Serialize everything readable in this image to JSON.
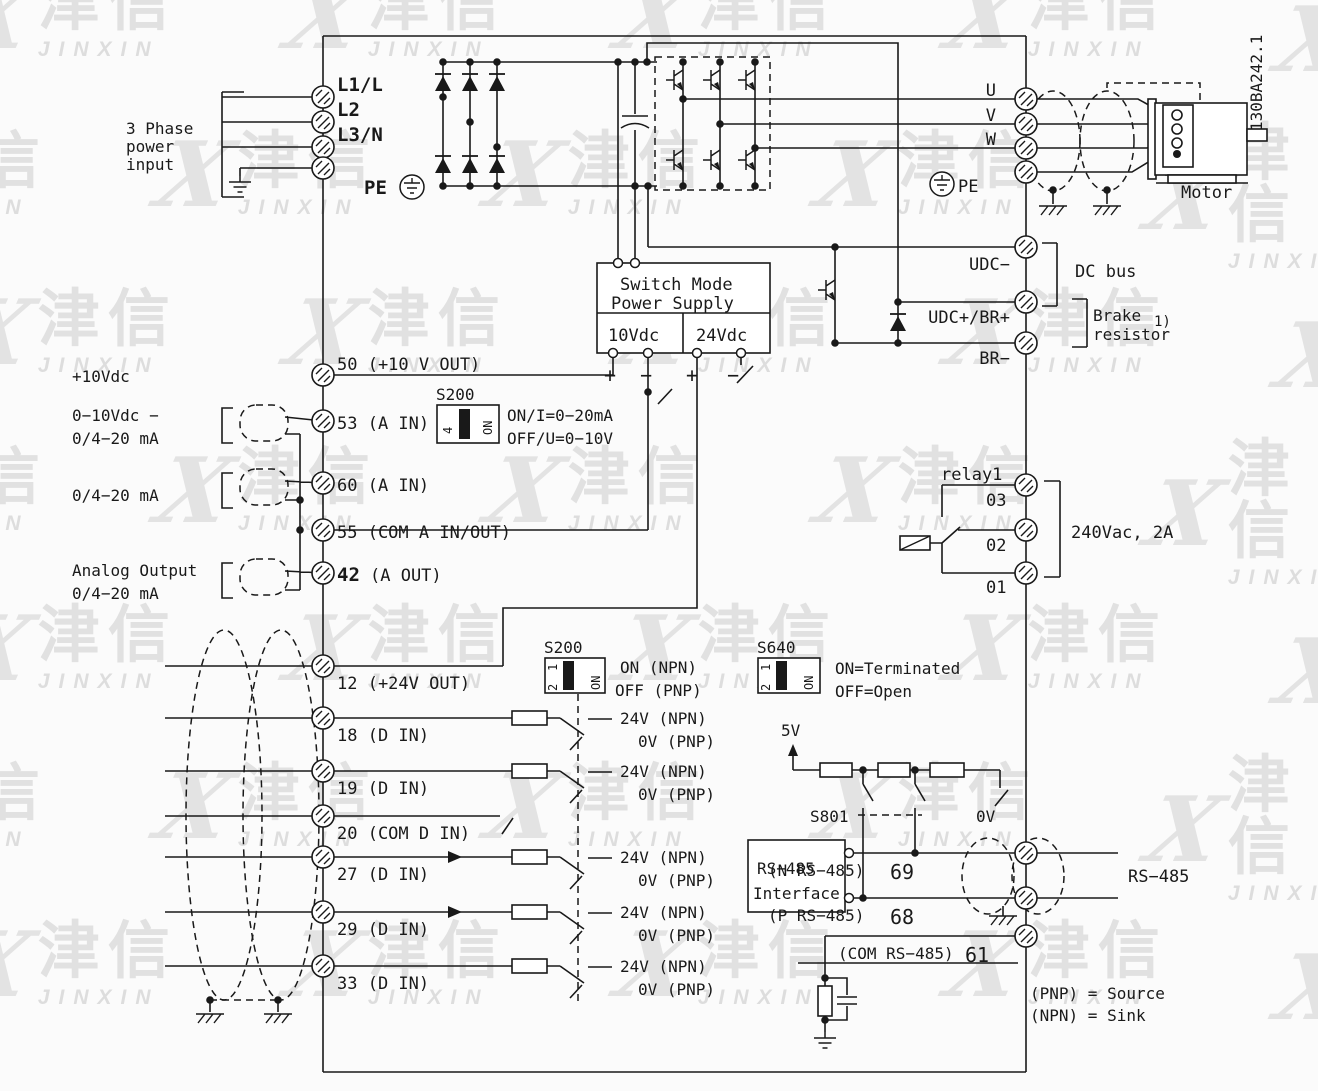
{
  "doc_number": "130BA242.1",
  "watermark": {
    "cn": "津信",
    "en": "JINXIN"
  },
  "power_input": {
    "line1": "3 Phase",
    "line2": "power",
    "line3": "input"
  },
  "input_terminals": {
    "l1": "L1/L",
    "l2": "L2",
    "l3": "L3/N",
    "pe": "PE"
  },
  "smps": {
    "title1": "Switch Mode",
    "title2": "Power Supply",
    "v10": "10Vdc",
    "v24": "24Vdc",
    "plus": "+",
    "minus": "−"
  },
  "motor_side": {
    "u": "U",
    "v": "V",
    "w": "W",
    "pe": "PE",
    "motor": "Motor"
  },
  "dc_section": {
    "udc_minus": "UDC−",
    "udc_plus": "UDC+/BR+",
    "br_minus": "BR−",
    "bus": "DC bus",
    "brake1": "Brake",
    "brake2": "resistor",
    "note": "1)"
  },
  "analog": {
    "plus10": "+10Vdc",
    "in53a": "0−10Vdc −",
    "in53b": "0/4−20 mA",
    "in60": "0/4−20 mA",
    "out42a": "Analog Output",
    "out42b": "0/4−20 mA",
    "t50": "50 (+10 V OUT)",
    "t53": "53 (A IN)",
    "t60": "60 (A IN)",
    "t55": "55 (COM A IN/OUT)",
    "t42_num": "42",
    "t42_rest": "(A OUT)"
  },
  "s200_analog": {
    "name": "S200",
    "pos": "4",
    "on": "ON",
    "line1": "ON/I=0−20mA",
    "line2": "OFF/U=0−10V"
  },
  "relay": {
    "name": "relay1",
    "t03": "03",
    "t02": "02",
    "t01": "01",
    "rating": "240Vac, 2A"
  },
  "digital": {
    "t12": "12 (+24V OUT)",
    "t18": "18 (D IN)",
    "t19": "19 (D IN)",
    "t20": "20 (COM D IN)",
    "t27": "27 (D IN)",
    "t29": "29 (D IN)",
    "t33": "33 (D IN)",
    "npn": "24V (NPN)",
    "pnp": "0V (PNP)"
  },
  "s200_digital": {
    "name": "S200",
    "pos1": "1",
    "pos2": "2",
    "on": "ON",
    "line1": "ON (NPN)",
    "line2": "OFF (PNP)"
  },
  "s640": {
    "name": "S640",
    "pos1": "1",
    "pos2": "2",
    "on": "ON",
    "line1": "ON=Terminated",
    "line2": "OFF=Open"
  },
  "termination": {
    "v5": "5V",
    "v0_pull": "0V",
    "s801": "S801"
  },
  "rs485": {
    "box1": "RS−485",
    "box2": "Interface",
    "t69_label": "(N RS−485)",
    "t69_num": "69",
    "t68_label": "(P RS−485)",
    "t68_num": "68",
    "t61_label": "(COM RS−485)",
    "t61_num": "61",
    "right": "RS−485"
  },
  "footer": {
    "pnp": "(PNP) = Source",
    "npn": "(NPN) = Sink"
  }
}
